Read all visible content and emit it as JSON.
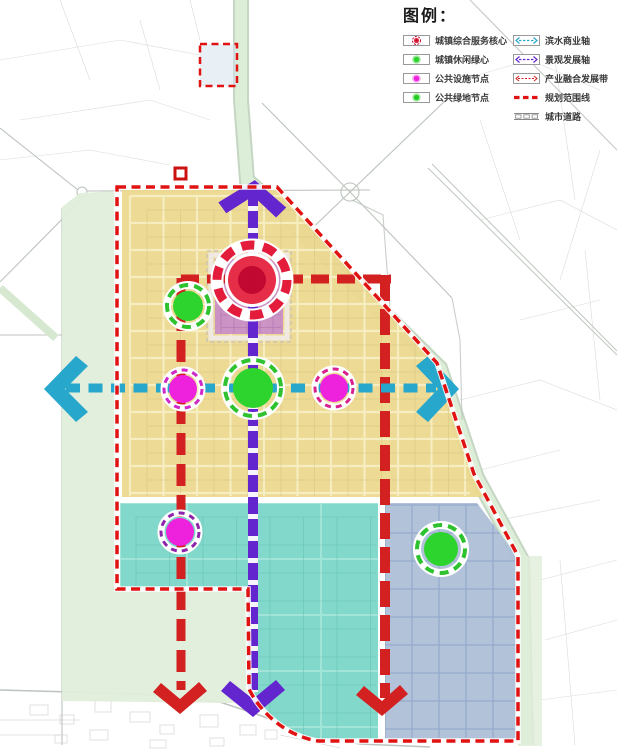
{
  "legend": {
    "title": "图例：",
    "left_items": [
      {
        "label": "城镇综合服务核心",
        "icon": "service-core-icon"
      },
      {
        "label": "城镇休闲绿心",
        "icon": "leisure-green-icon"
      },
      {
        "label": "公共设施节点",
        "icon": "facility-node-icon"
      },
      {
        "label": "公共绿地节点",
        "icon": "green-node-icon"
      }
    ],
    "right_items": [
      {
        "label": "滨水商业轴",
        "icon": "waterfront-axis-icon"
      },
      {
        "label": "景观发展轴",
        "icon": "landscape-axis-icon"
      },
      {
        "label": "产业融合发展带",
        "icon": "industry-belt-icon"
      },
      {
        "label": "规划范围线",
        "icon": "boundary-line-icon"
      },
      {
        "label": "城市道路",
        "icon": "city-road-icon"
      }
    ]
  },
  "colors": {
    "boundary_red": "#E01212",
    "axis_red": "#D32121",
    "axis_purple": "#6325CE",
    "axis_cyan": "#28A7CC",
    "zone_yellow": "#EBD88F",
    "zone_teal": "#7ED7C8",
    "zone_blue": "#AEC0D8",
    "zone_green_light": "#E0EEDA",
    "zone_pink": "#C98FC6",
    "river_green": "#DCEDD8",
    "node_magenta": "#EE22DD",
    "node_green": "#2ED42E",
    "core_red": "#E62E48",
    "core_dark": "#C00830"
  },
  "map": {
    "nodes": [
      {
        "name": "node-service-core",
        "type": "core",
        "x": 252,
        "y": 280,
        "r": 24,
        "ring": 35,
        "fillColor": "#E62E48",
        "ringColor": "#E31C3C",
        "coreColor": "#C00830"
      },
      {
        "name": "node-leisure-green",
        "type": "green",
        "x": 188,
        "y": 306,
        "r": 15,
        "ring": 21,
        "fillColor": "#2ED42E",
        "ringColor": "#2EC22E"
      },
      {
        "name": "node-facility-west",
        "type": "magenta",
        "x": 183,
        "y": 389,
        "r": 14,
        "ring": 19,
        "fillColor": "#EE22DD",
        "ringColor": "#CE28C8"
      },
      {
        "name": "node-public-green-center",
        "type": "green",
        "x": 253,
        "y": 388,
        "r": 20,
        "ring": 28,
        "fillColor": "#2ED42E",
        "ringColor": "#2EC22E"
      },
      {
        "name": "node-facility-east",
        "type": "magenta",
        "x": 334,
        "y": 388,
        "r": 14,
        "ring": 19,
        "fillColor": "#EE22DD",
        "ringColor": "#D8218F"
      },
      {
        "name": "node-facility-south",
        "type": "magenta",
        "x": 180,
        "y": 532,
        "r": 14,
        "ring": 19,
        "fillColor": "#EE22DD",
        "ringColor": "#8E24AA"
      },
      {
        "name": "node-public-green-southeast",
        "type": "green",
        "x": 441,
        "y": 549,
        "r": 17,
        "ring": 24,
        "fillColor": "#2ED42E",
        "ringColor": "#2EC22E"
      }
    ]
  }
}
